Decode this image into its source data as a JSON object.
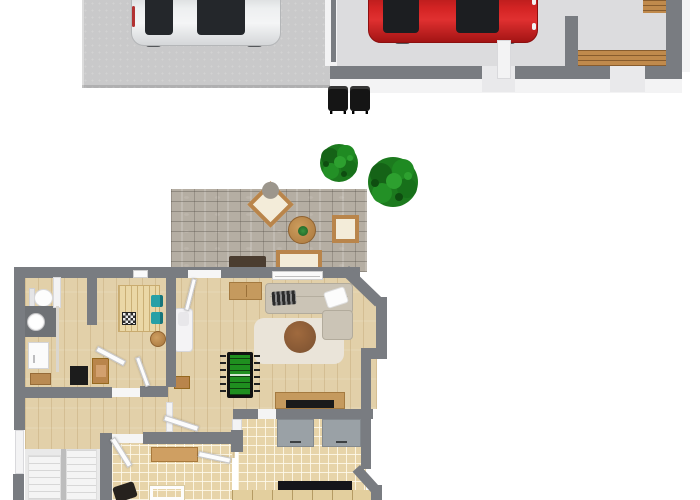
{
  "meta": {
    "description": "3D rendered residential floor plan: driveway and garage at top, yard with two trees and a stone patio in the middle, furnished ground floor below",
    "canvas_width": 700,
    "canvas_height": 500,
    "visible_text": ""
  },
  "palette": {
    "background": "#ffffff",
    "wall_gray": "#797c81",
    "wall_face_white": "#f3f3f4",
    "driveway_concrete": "#c9c9ca",
    "garage_floor": "#dcdcde",
    "wood_floor": "#e2d0a9",
    "tile_floor": "#e7d4a9",
    "patio_paver": "#b5aea3",
    "tree_green": "#1e7a1e",
    "car_red": "#c32020",
    "car_silver": "#e6e8ea",
    "sofa_beige": "#cbc4b6",
    "ottoman_brown": "#8a5c36",
    "foosball_green": "#1f8f1f",
    "teal_chair": "#27a0a6",
    "wood_furniture": "#c08c50"
  },
  "outdoor": {
    "driveway": {
      "vehicle": "silver hatchback (top view)",
      "trash_bins": 2
    },
    "garage": {
      "vehicle": "red car (top view)",
      "features": [
        "wooden entry stairs",
        "two door openings in south wall",
        "interior wall stubs"
      ]
    },
    "yard": {
      "trees": 2,
      "patio": {
        "material": "stone pavers",
        "furniture": [
          "rotated lounge chair with gray cushion",
          "round wooden side table with plant",
          "square lounge chair",
          "outdoor wooden sofa with cream cushion",
          "dark brown coffee table"
        ]
      }
    }
  },
  "house": {
    "rooms": [
      {
        "name": "bathroom",
        "items": [
          "toilet",
          "dark vanity with round sink",
          "washing machine",
          "wooden bench"
        ]
      },
      {
        "name": "dining room",
        "items": [
          "plank dining table",
          "chessboard",
          "teal chair x2",
          "round wooden stool",
          "wooden desk",
          "black cabinet"
        ]
      },
      {
        "name": "living room",
        "items": [
          "wooden sideboard",
          "L-shaped beige sectional sofa",
          "striped dark pillow",
          "white pillow",
          "round brown ottoman",
          "pale area rug",
          "foosball table",
          "white daybed",
          "wooden stool",
          "media console with TV"
        ]
      },
      {
        "name": "kitchen",
        "items": [
          "gray cabinet x2",
          "dark countertop",
          "base cabinet row"
        ]
      },
      {
        "name": "storage room",
        "items": [
          "wooden shelf",
          "white table frame",
          "dark equipment"
        ]
      },
      {
        "name": "hallway",
        "items": [
          "open door leaves"
        ]
      },
      {
        "name": "staircase",
        "items": [
          "two white flights"
        ]
      }
    ]
  }
}
